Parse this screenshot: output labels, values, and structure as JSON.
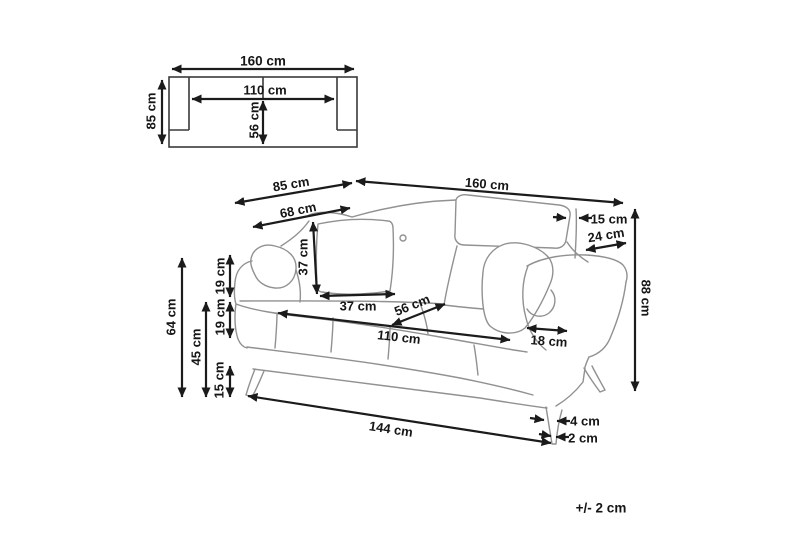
{
  "figure": {
    "background": "#ffffff",
    "sofa_line_color": "#919191",
    "dimension_color": "#1b1b1b",
    "tolerance_note": "+/- 2 cm"
  },
  "top_view": {
    "overall_width": "160 cm",
    "seat_width": "110 cm",
    "overall_depth": "85 cm",
    "seat_depth": "56 cm"
  },
  "sofa_view": {
    "overall_depth": "85 cm",
    "overall_width": "160 cm",
    "arm_front_to_back": "68 cm",
    "headrest_inset": "15 cm",
    "headrest_depth": "24 cm",
    "overall_height": "88 cm",
    "cushion_height": "37 cm",
    "cushion_width": "37 cm",
    "seat_depth": "56 cm",
    "seat_width": "110 cm",
    "armrest_width": "18 cm",
    "backrest_segment_upper": "19 cm",
    "backrest_segment_lower": "19 cm",
    "arm_height": "64 cm",
    "seat_height": "45 cm",
    "leg_height": "15 cm",
    "base_width": "144 cm",
    "leg_width_top": "4 cm",
    "leg_width_bottom": "2 cm"
  }
}
